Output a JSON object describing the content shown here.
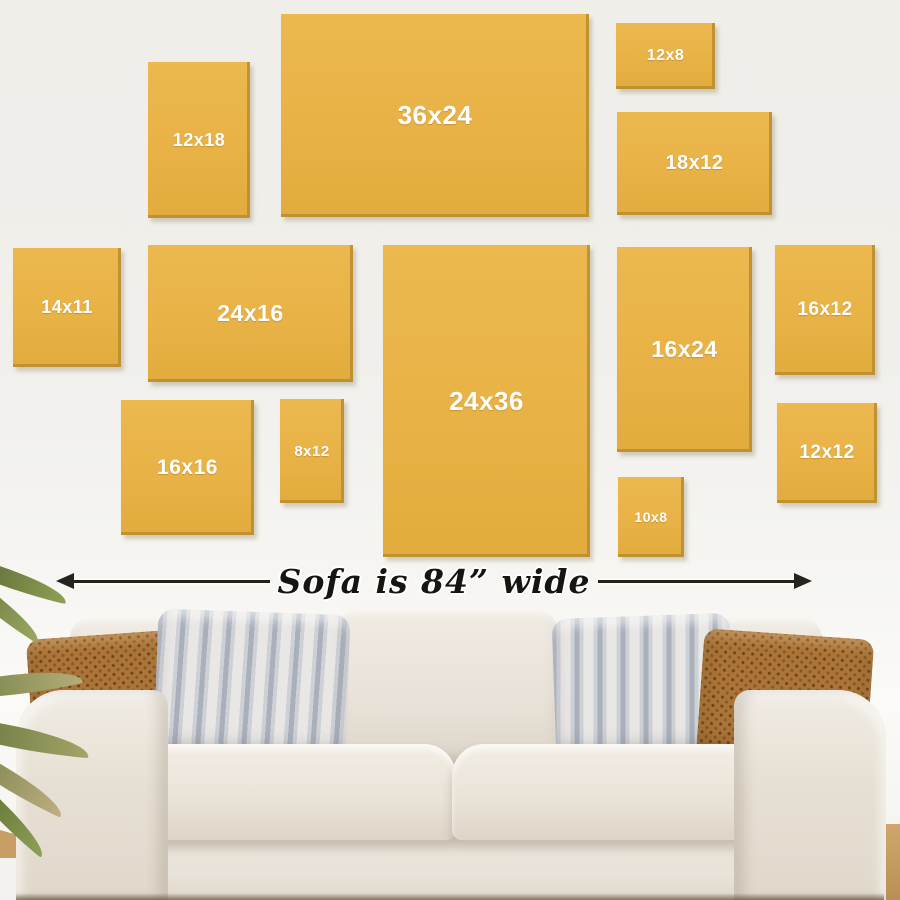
{
  "annotation": {
    "text": "Sofa is 84” wide"
  },
  "frames": [
    {
      "label": "12x18",
      "x": 148,
      "y": 62,
      "w": 102,
      "h": 156,
      "font": 18
    },
    {
      "label": "36x24",
      "x": 281,
      "y": 14,
      "w": 308,
      "h": 203,
      "font": 26
    },
    {
      "label": "12x8",
      "x": 616,
      "y": 23,
      "w": 99,
      "h": 66,
      "font": 16
    },
    {
      "label": "18x12",
      "x": 617,
      "y": 112,
      "w": 155,
      "h": 103,
      "font": 20
    },
    {
      "label": "14x11",
      "x": 13,
      "y": 248,
      "w": 108,
      "h": 119,
      "font": 18
    },
    {
      "label": "24x16",
      "x": 148,
      "y": 245,
      "w": 205,
      "h": 137,
      "font": 23
    },
    {
      "label": "16x16",
      "x": 121,
      "y": 400,
      "w": 133,
      "h": 135,
      "font": 21
    },
    {
      "label": "8x12",
      "x": 280,
      "y": 399,
      "w": 64,
      "h": 104,
      "font": 15
    },
    {
      "label": "24x36",
      "x": 383,
      "y": 245,
      "w": 207,
      "h": 312,
      "font": 26
    },
    {
      "label": "16x24",
      "x": 617,
      "y": 247,
      "w": 135,
      "h": 205,
      "font": 23
    },
    {
      "label": "16x12",
      "x": 775,
      "y": 245,
      "w": 100,
      "h": 130,
      "font": 19
    },
    {
      "label": "12x12",
      "x": 777,
      "y": 403,
      "w": 100,
      "h": 100,
      "font": 19
    },
    {
      "label": "10x8",
      "x": 618,
      "y": 477,
      "w": 66,
      "h": 80,
      "font": 14
    }
  ],
  "colors": {
    "wall": "#efeee9",
    "frame_fill": "#e8b246",
    "frame_edge_shadow": "#ba8c2e",
    "frame_label_text": "#ffffff",
    "annotation_ink": "#26221d",
    "sofa_fabric": "#eae4db",
    "pillow_rust": "#ab7539",
    "pillow_stripe_gray": "#aab0bb",
    "pillow_stripe_light": "#e9e7e5",
    "plant_green": "#6b7a3c",
    "wood_floor": "#c79e63"
  }
}
